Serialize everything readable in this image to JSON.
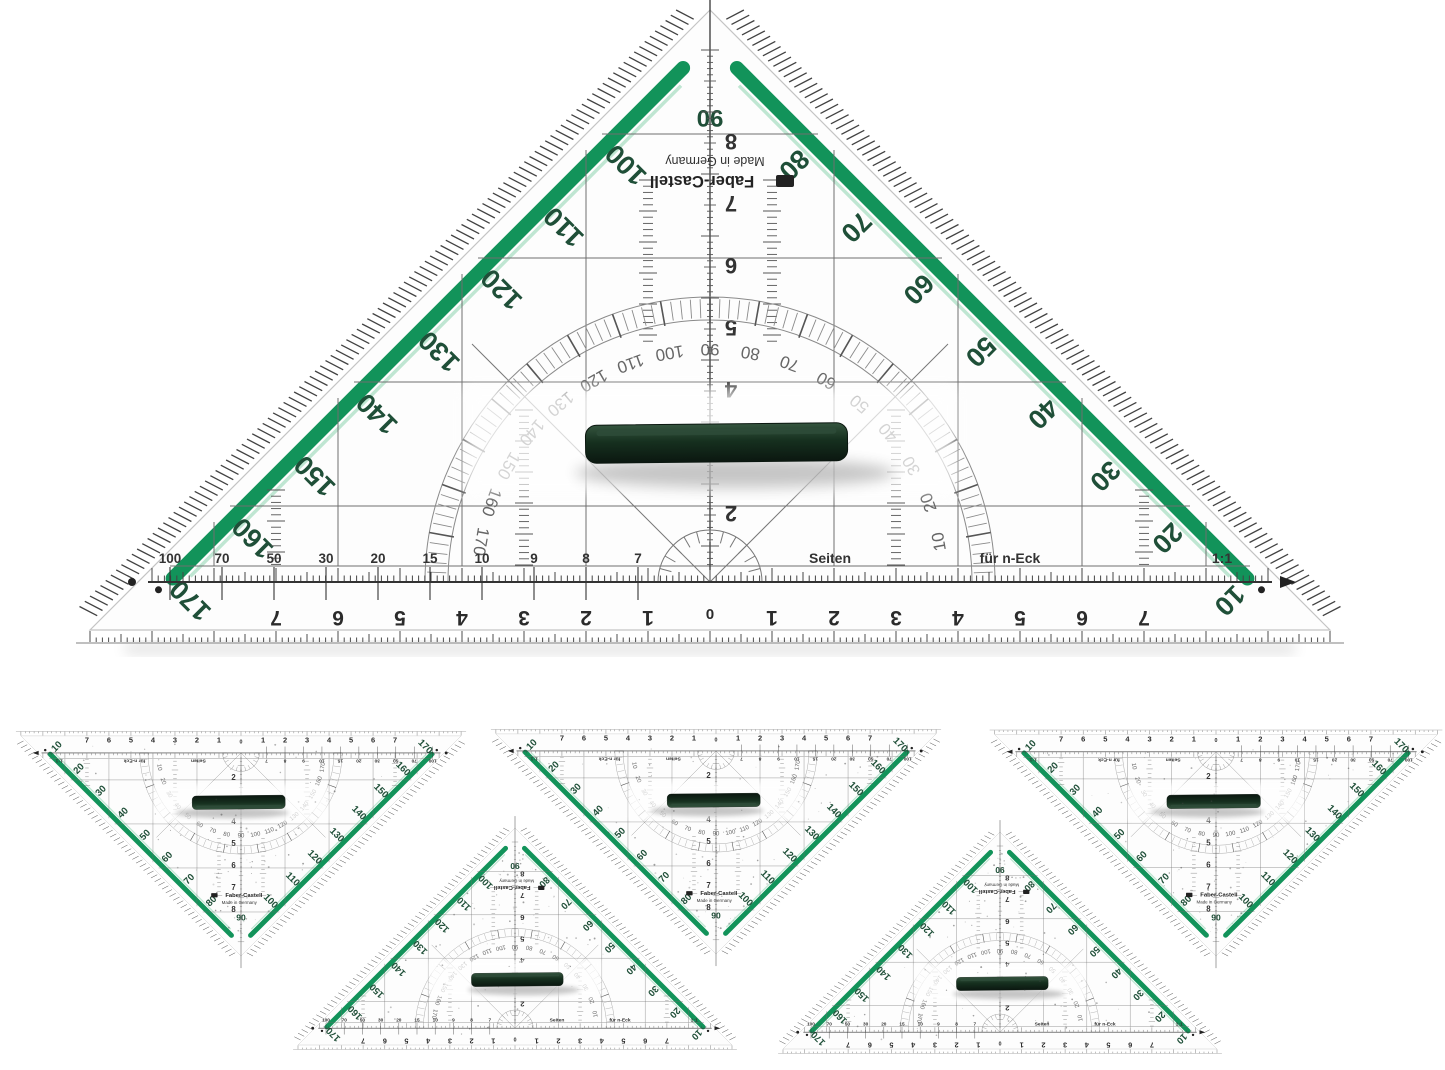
{
  "photo": {
    "background": "#ffffff",
    "subject": "set-square-geometry-triangles",
    "count_large": 1,
    "count_small": 5
  },
  "colors": {
    "green": "#12935a",
    "green_light": "#bfe6d2",
    "ink": "#2f3430",
    "degree_ink": "#1f4f38",
    "grid_gray": "#6f6f6f",
    "arc_gray": "#8a8a8a",
    "handle_dark": "#0b1710",
    "handle_mid": "#2e4c39"
  },
  "brand": {
    "name": "Faber-Castell",
    "origin": "Made in Germany"
  },
  "deg": {
    "apex": "90",
    "left": [
      "100",
      "110",
      "120",
      "130",
      "140",
      "150",
      "160",
      "170"
    ],
    "right": [
      "80",
      "70",
      "60",
      "50",
      "40",
      "30",
      "20",
      "10"
    ]
  },
  "arc": {
    "deg": [
      "10",
      "20",
      "30",
      "40",
      "50",
      "60",
      "70",
      "80",
      "90",
      "100",
      "110",
      "120",
      "130",
      "140",
      "150",
      "160",
      "170"
    ]
  },
  "ruler": {
    "cm": [
      "1",
      "2",
      "3",
      "4",
      "5",
      "6",
      "7"
    ],
    "zero": "0"
  },
  "center_scale": {
    "cm": [
      "2",
      "3",
      "4",
      "5",
      "6",
      "7",
      "8"
    ]
  },
  "poly": {
    "values": [
      "100",
      "70",
      "50",
      "30",
      "20",
      "15",
      "10",
      "9",
      "8",
      "7"
    ],
    "seiten": "Seiten",
    "neck": "für n-Eck",
    "ratio": "1:1"
  }
}
